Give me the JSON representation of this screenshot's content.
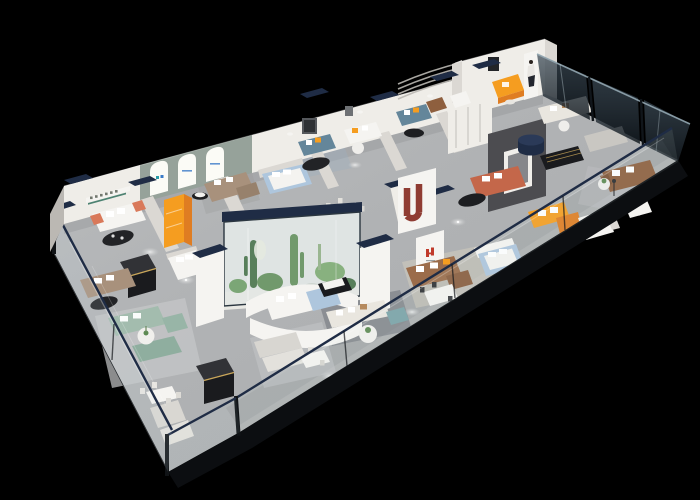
{
  "scene": {
    "type": "3d-isometric-interior-render",
    "subject": "furniture showroom floor-plan cutaway viewed from above at an angle",
    "background": "#000000"
  },
  "palette": {
    "background": "#000000",
    "floor": "#aeb0b2",
    "floor_light": "#c9cbcc",
    "wall_bright": "#efede8",
    "wall_mid": "#dbd8d3",
    "wall_dark": "#bbb8b3",
    "wall_sage": "#96a29a",
    "navy": "#1f2c45",
    "glass_dark": "#27323c",
    "glass_light": "#cfe0e6",
    "charcoal": "#0c0e11",
    "feature_wall": "#4c4c50",
    "black_furniture": "#1a1b1e",
    "gold_trim": "#c9a659",
    "orange": "#f59d20",
    "orange_deep": "#df7d22",
    "coral": "#d9795a",
    "sunset_sofa": "#c4674a",
    "red_accent": "#8f3c33",
    "logo_red": "#c03a2b",
    "teal_sofa": "#64869a",
    "teal_ottoman": "#7ba3a8",
    "sage_sofa": "#a3bcae",
    "taupe_sofa": "#a8917c",
    "brown_leather": "#8e5f3e",
    "cream": "#e9e6df",
    "white_soft": "#f5f4f1",
    "bed_blue": "#aec6dd",
    "plant_green": "#5d8a52",
    "plant_dark": "#3f6b3e",
    "rug_light": "#c6c8c9",
    "rug_blue": "#9fb0bc",
    "rug_dark": "#686c73",
    "rug_beige": "#cfc9bd",
    "light_pool": "#eceded",
    "arch_glow": "#fbfbf6",
    "arch_logo_blue": "#3a7bc8",
    "arch_logo_teal": "#2a9daa",
    "sign_glyph": "#73786f",
    "sign_underline": "#4d8272"
  },
  "objects": [
    {
      "name": "front-glass-facade",
      "color_key": "glass_light"
    },
    {
      "name": "navy-glass-railing",
      "color_key": "navy"
    },
    {
      "name": "back-wall",
      "color_key": "wall_bright"
    },
    {
      "name": "arched-window-wall",
      "color_key": "wall_sage"
    },
    {
      "name": "planted-glass-terrarium",
      "color_key": "plant_green"
    },
    {
      "name": "orange-display-wardrobe",
      "color_key": "orange"
    },
    {
      "name": "orange-chaise-sofa",
      "color_key": "orange"
    },
    {
      "name": "red-arch-sculpture",
      "color_key": "red_accent"
    },
    {
      "name": "red-brand-mark",
      "color_key": "logo_red"
    },
    {
      "name": "teal-fabric-sofas",
      "color_key": "teal_sofa"
    },
    {
      "name": "sage-green-sofa-set",
      "color_key": "sage_sofa"
    },
    {
      "name": "brown-leather-sofa",
      "color_key": "brown_leather"
    },
    {
      "name": "coral-trim-sofa",
      "color_key": "coral"
    },
    {
      "name": "sunset-orange-sofa",
      "color_key": "sunset_sofa"
    },
    {
      "name": "navy-cylinder-table",
      "color_key": "navy"
    },
    {
      "name": "black-display-counters",
      "color_key": "black_furniture"
    },
    {
      "name": "feature-media-wall",
      "color_key": "feature_wall"
    },
    {
      "name": "light-blue-beds",
      "color_key": "bed_blue"
    },
    {
      "name": "hostess-banner",
      "color_key": "white_soft"
    },
    {
      "name": "ceiling-light-pools",
      "color_key": "light_pool"
    }
  ]
}
